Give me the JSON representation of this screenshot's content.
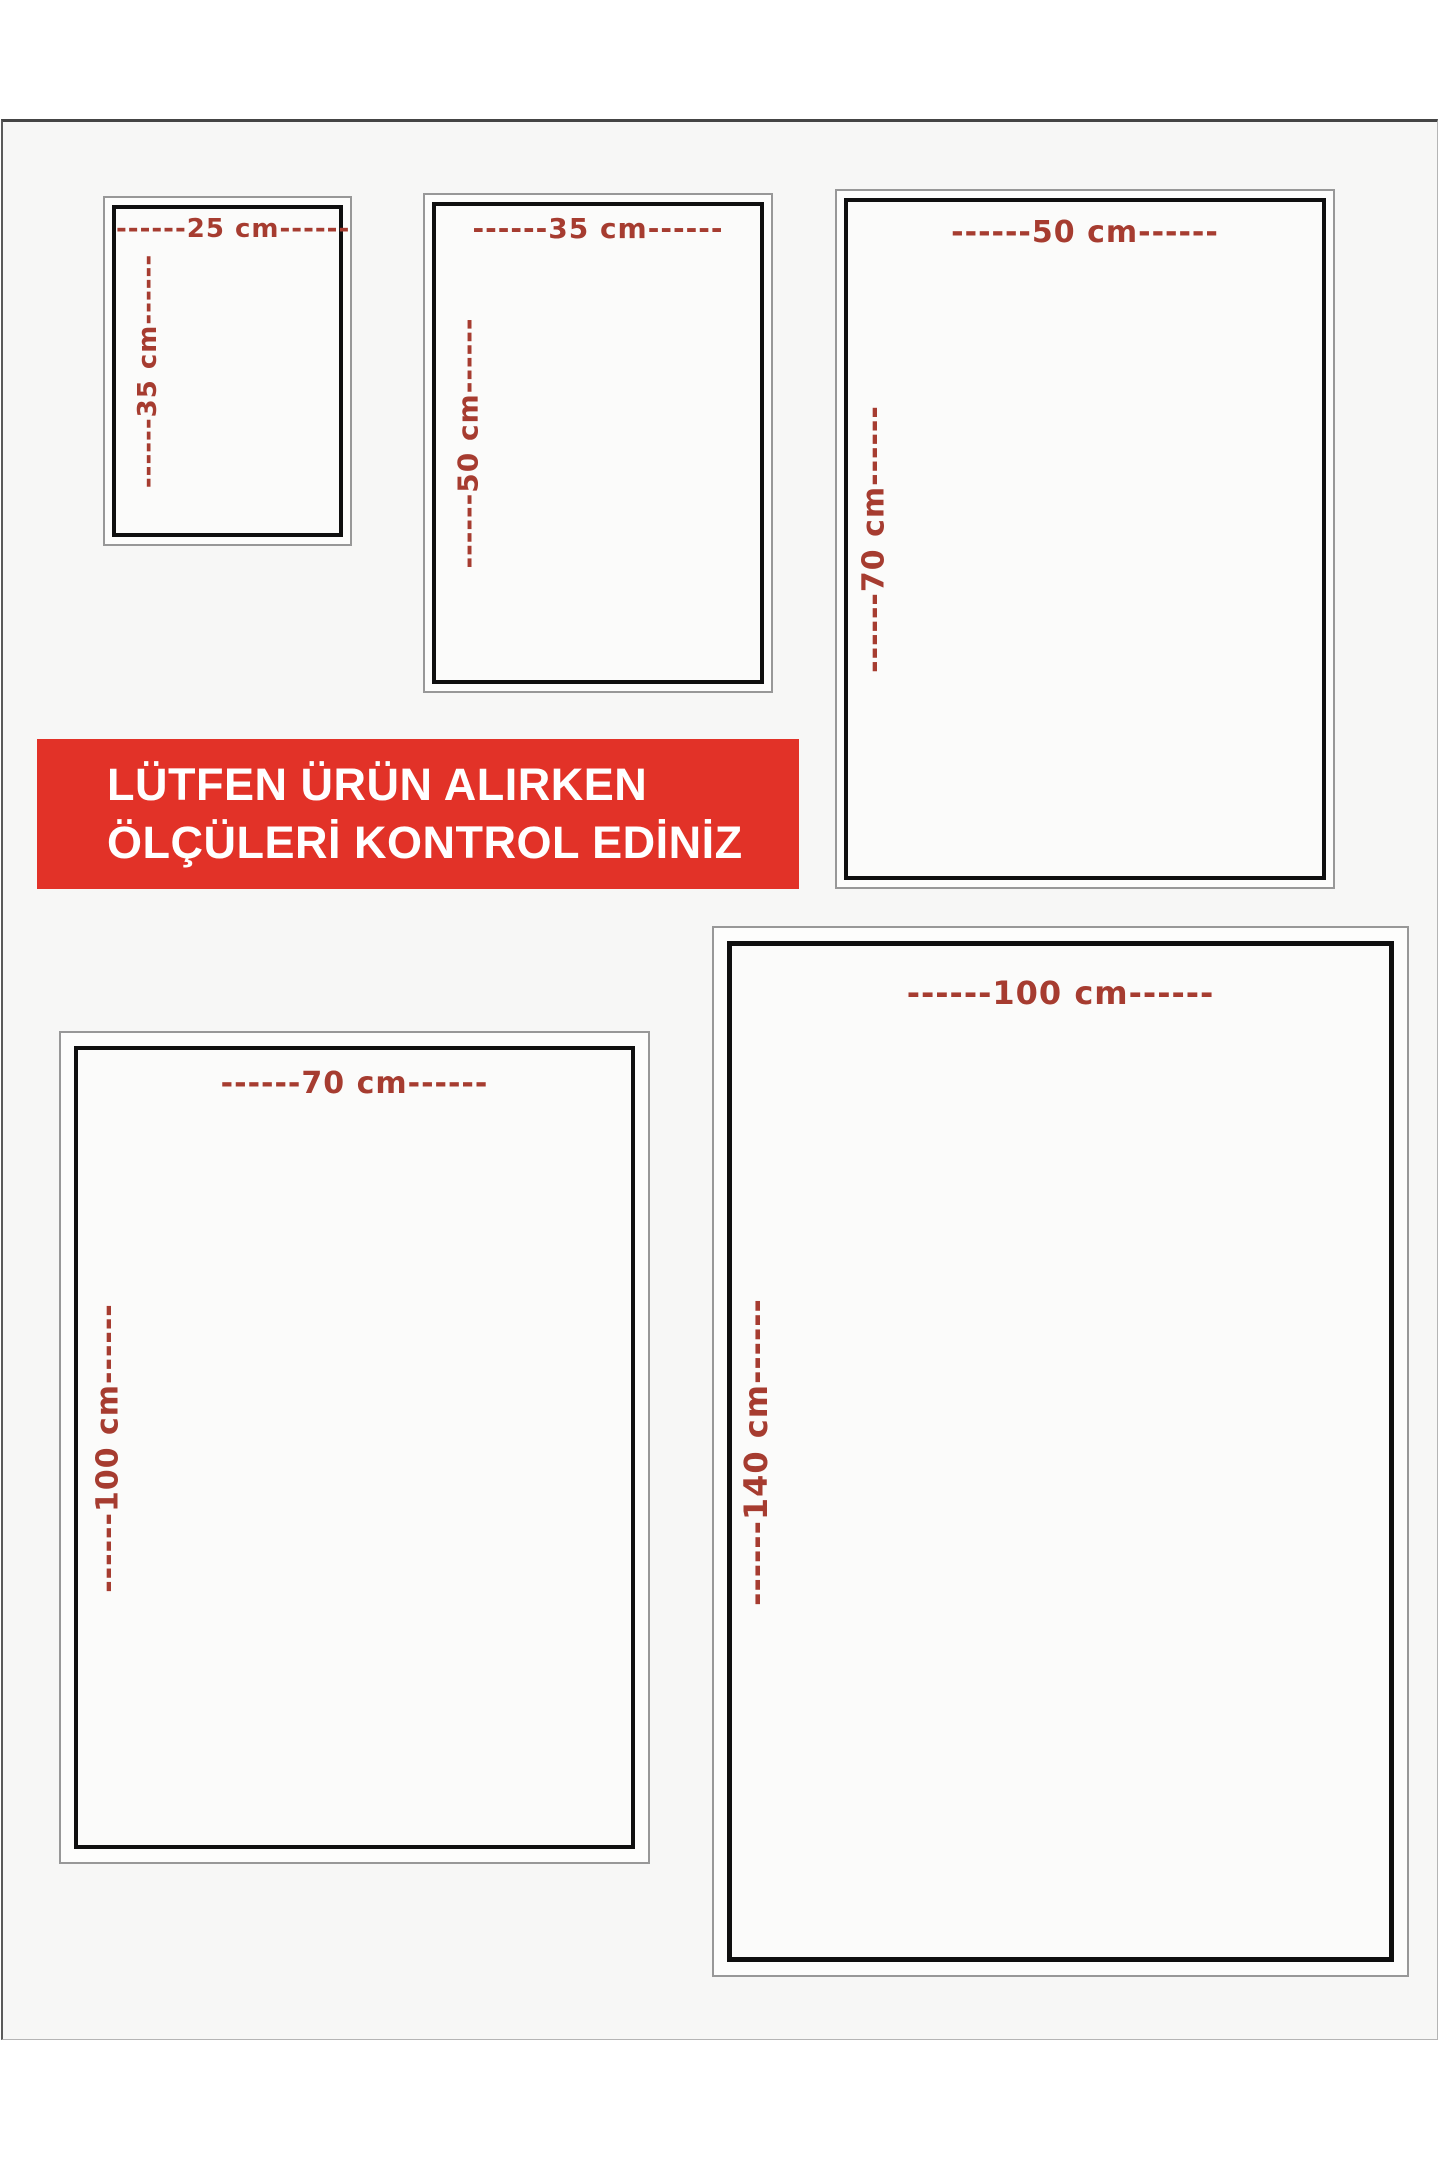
{
  "banner": {
    "line1": "LÜTFEN ÜRÜN ALIRKEN",
    "line2": "ÖLÇÜLERİ KONTROL EDİNİZ",
    "background_color": "#e23228",
    "text_color": "#ffffff"
  },
  "colors": {
    "dimension_label_red": "#a63c30",
    "inner_border_black": "#0f0f0f",
    "outer_border_gray": "#989898",
    "page_background": "#f7f7f6"
  },
  "sizes": [
    {
      "name": "25x35",
      "width_cm": 25,
      "height_cm": 35,
      "width_label": "------25 cm------",
      "height_label": "------35 cm------"
    },
    {
      "name": "35x50",
      "width_cm": 35,
      "height_cm": 50,
      "width_label": "------35 cm------",
      "height_label": "------50 cm------"
    },
    {
      "name": "50x70",
      "width_cm": 50,
      "height_cm": 70,
      "width_label": "------50 cm------",
      "height_label": "------70 cm------"
    },
    {
      "name": "70x100",
      "width_cm": 70,
      "height_cm": 100,
      "width_label": "------70 cm------",
      "height_label": "------100 cm------"
    },
    {
      "name": "100x140",
      "width_cm": 100,
      "height_cm": 140,
      "width_label": "------100 cm------",
      "height_label": "------140 cm------"
    }
  ]
}
